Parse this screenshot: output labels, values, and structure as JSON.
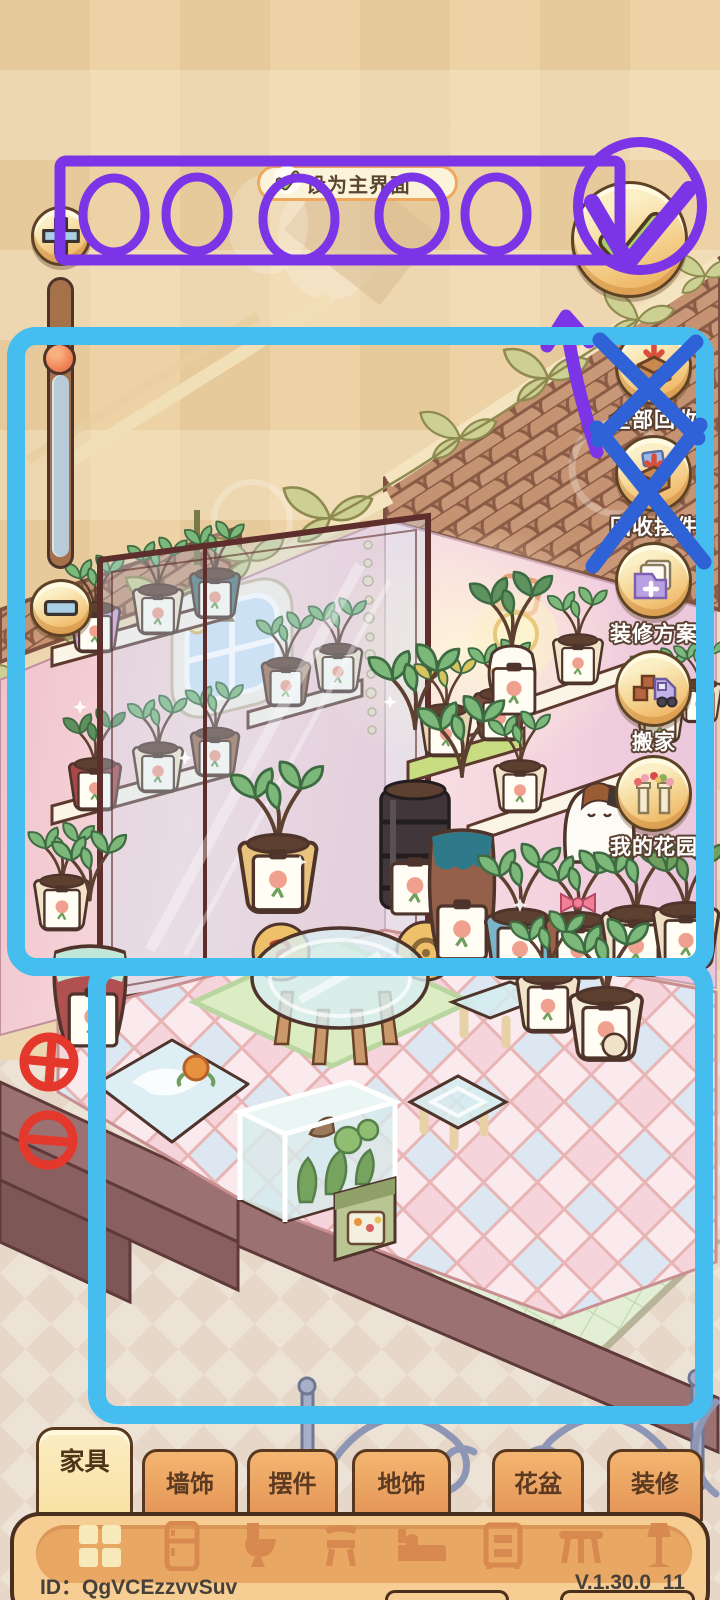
{
  "header": {
    "set_main_label": "设为主界面"
  },
  "controls": {
    "zoom_in_icon": "plus-icon",
    "zoom_out_icon": "minus-icon",
    "confirm_icon": "green-checkmark-icon",
    "slider": "zoom-level-slider"
  },
  "right_menu": {
    "items": [
      {
        "label": "全部回收",
        "icon": "recycle-all-box-icon"
      },
      {
        "label": "回收摆件",
        "icon": "recycle-ornaments-box-icon"
      },
      {
        "label": "装修方案",
        "icon": "decor-plan-folder-icon"
      },
      {
        "label": "搬家",
        "icon": "moving-truck-icon"
      },
      {
        "label": "我的花园",
        "icon": "garden-arch-icon"
      }
    ]
  },
  "tabs": [
    {
      "label": "家具",
      "active": true
    },
    {
      "label": "墙饰",
      "active": false
    },
    {
      "label": "摆件",
      "active": false
    },
    {
      "label": "地饰",
      "active": false
    },
    {
      "label": "花盆",
      "active": false
    },
    {
      "label": "装修",
      "active": false
    }
  ],
  "toolbar": {
    "categories": [
      {
        "icon": "grid-window-icon",
        "selected": true
      },
      {
        "icon": "fridge-icon",
        "selected": false
      },
      {
        "icon": "toilet-icon",
        "selected": false
      },
      {
        "icon": "chair-icon",
        "selected": false
      },
      {
        "icon": "bed-icon",
        "selected": false
      },
      {
        "icon": "nightstand-icon",
        "selected": false
      },
      {
        "icon": "table-icon",
        "selected": false
      },
      {
        "icon": "floor-lamp-icon",
        "selected": false
      }
    ]
  },
  "footer": {
    "player_id": "ID：QgVCEzzvvSuv",
    "version": "V.1.30.0_11"
  },
  "annotations": {
    "purple": "#7B35E6",
    "blue_frame": "#45BEEF",
    "blue_x": "#2E62D6",
    "red": "#E5382C"
  }
}
